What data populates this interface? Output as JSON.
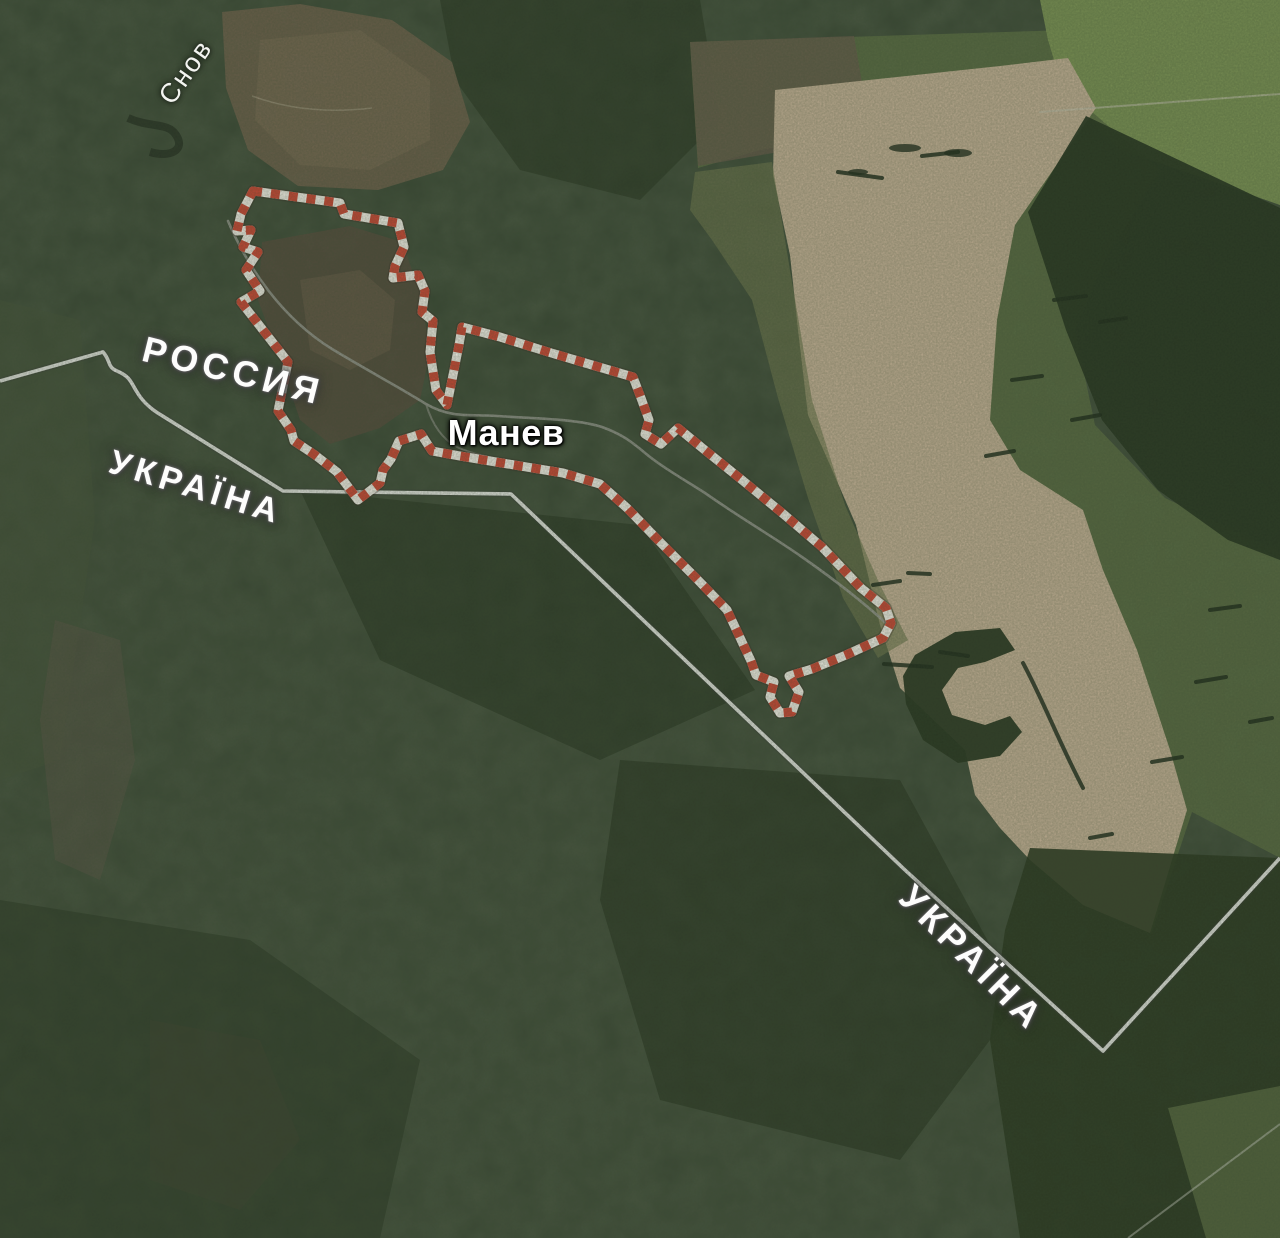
{
  "map": {
    "kind": "satellite-map",
    "labels": {
      "river": "Снов",
      "country_russia": "РОССИЯ",
      "country_ukraine_west": "УКРАЇНА",
      "settlement": "Манев",
      "country_ukraine_south": "УКРАЇНА"
    },
    "colors": {
      "highlight_red": "#cd4534",
      "highlight_white": "#f7f2ec",
      "state_border_line": "#e6e6e3",
      "forest_base": "#323f2e",
      "field_tan": "#c6b197",
      "label_white": "#ffffff"
    }
  }
}
